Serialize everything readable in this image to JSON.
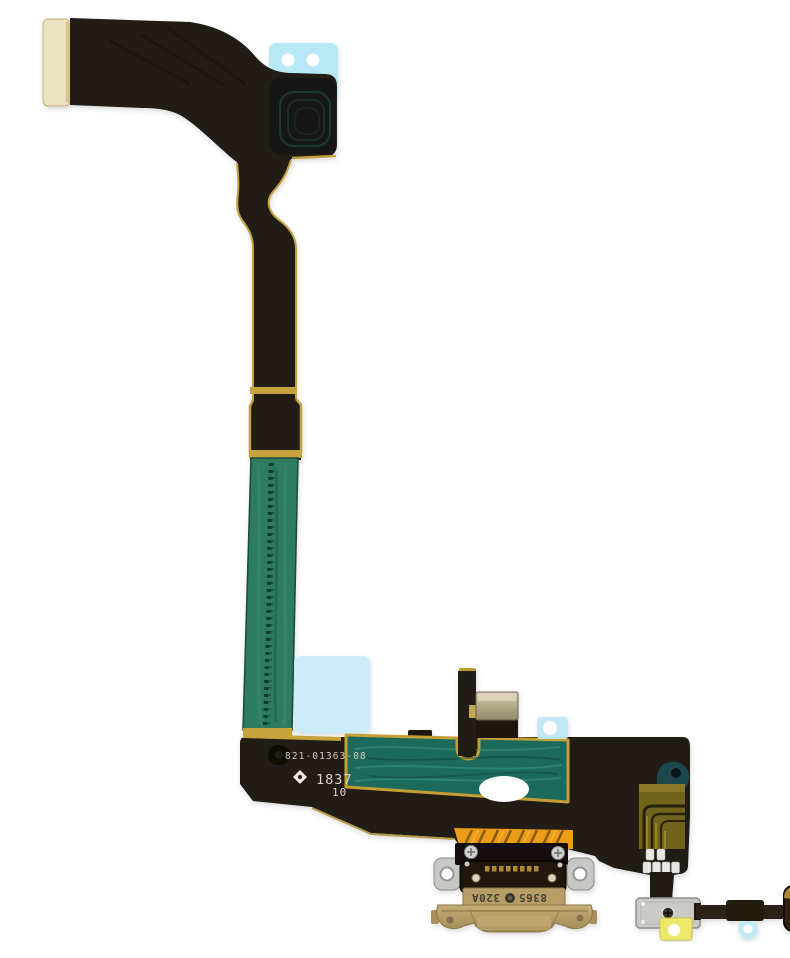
{
  "photo": {
    "subject": "charging-port-flex-cable",
    "background": "#ffffff"
  },
  "markings": {
    "part_number": "821-01363-08",
    "date_code": "1837",
    "revision": "10",
    "stamp_symbol": "diamond"
  },
  "connector_markings": {
    "model": "8365",
    "spec": "320A",
    "orientation": "rotated-180"
  },
  "colors": {
    "flex_black": "#231b13",
    "gold_edge": "#c2a040",
    "emi_green_strip": "#2d7b61",
    "emi_teal_patch": "#1d6b5c",
    "sticker_cyan": "#b7e8f5",
    "sticker_cyan_large": "#c9edf8",
    "sticker_yellow": "#eee868",
    "flex_orange": "#ec9c12",
    "trace_olive": "#72631c",
    "metal_gray": "#c9c9c5",
    "housing_tan": "#b79d67",
    "pad_gold": "#c59c3e",
    "connector_cream": "#eae1c0"
  }
}
